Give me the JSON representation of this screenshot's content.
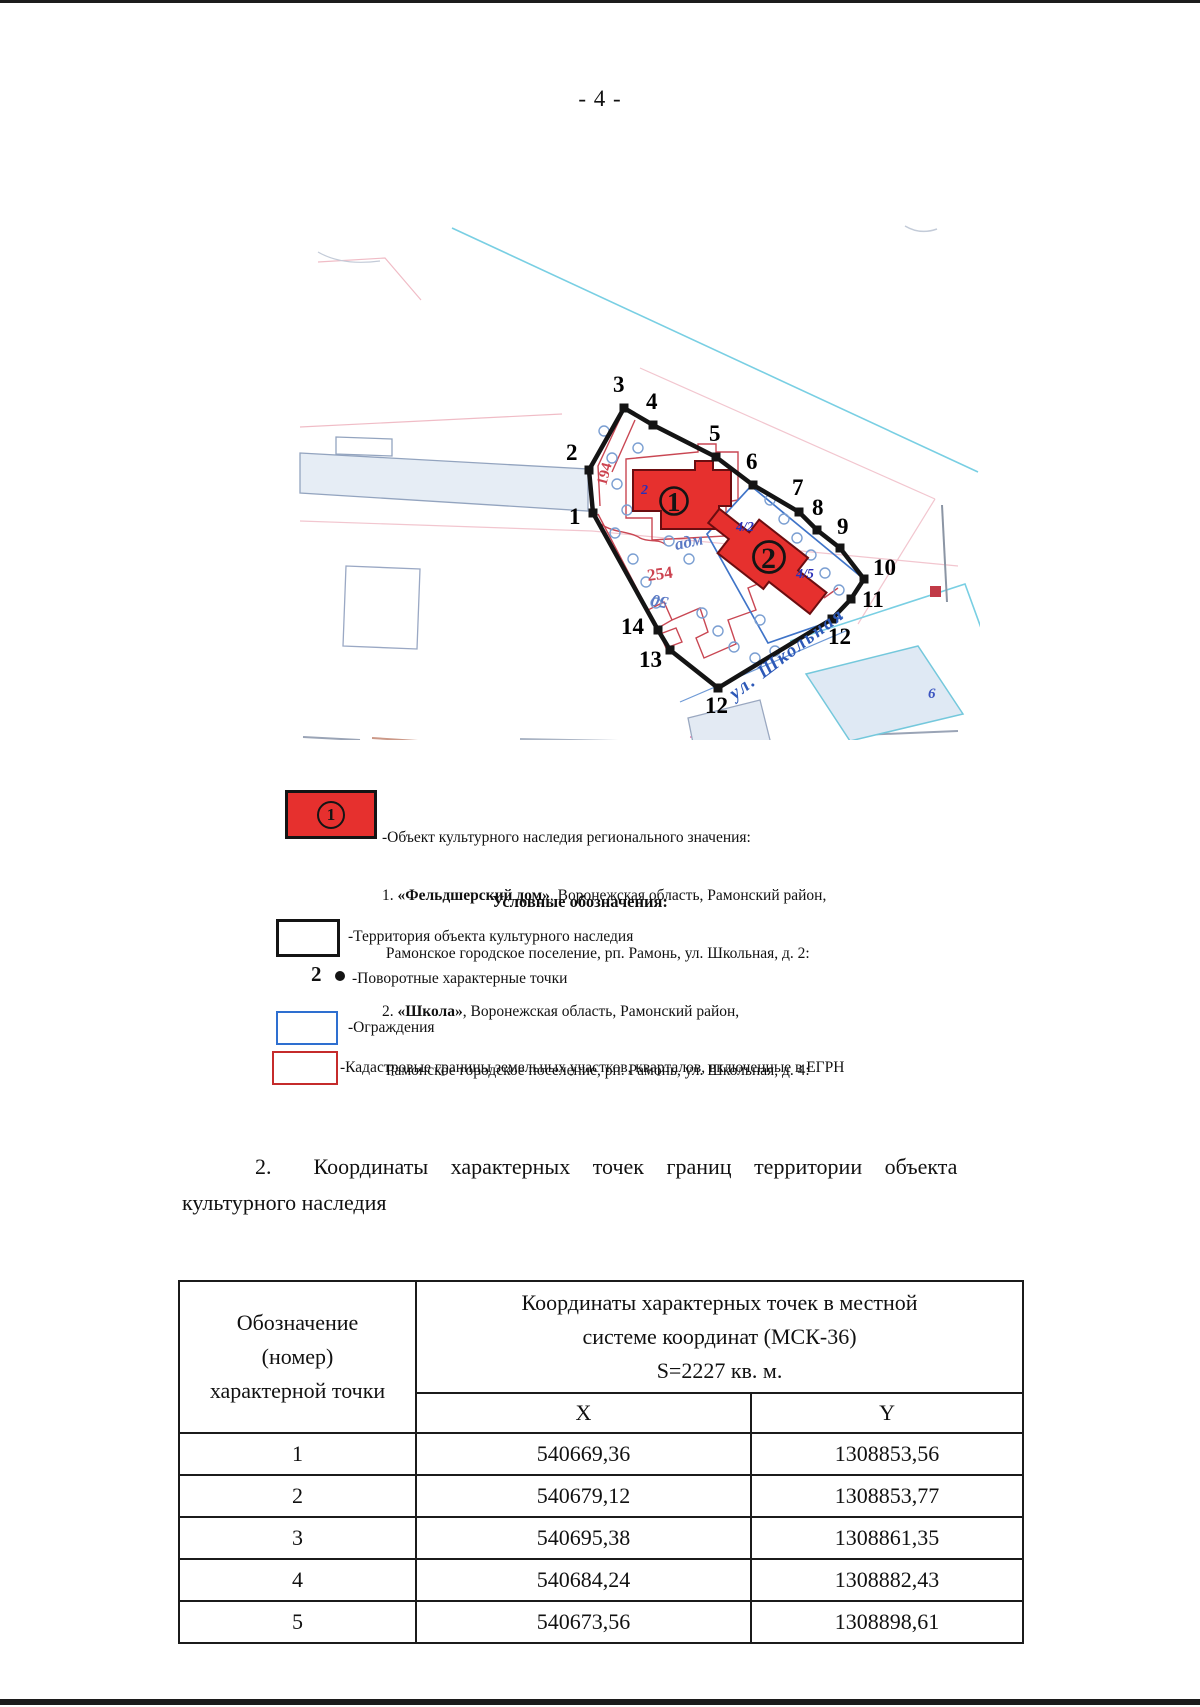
{
  "page": {
    "number": "- 4 -"
  },
  "map": {
    "boundary_points": [
      {
        "label": "1",
        "x": 593,
        "y": 513,
        "lx": 569,
        "ly": 524
      },
      {
        "label": "2",
        "x": 589,
        "y": 470,
        "lx": 566,
        "ly": 460
      },
      {
        "label": "3",
        "x": 624,
        "y": 408,
        "lx": 613,
        "ly": 392
      },
      {
        "label": "4",
        "x": 653,
        "y": 425,
        "lx": 646,
        "ly": 409
      },
      {
        "label": "5",
        "x": 716,
        "y": 457,
        "lx": 709,
        "ly": 441
      },
      {
        "label": "6",
        "x": 753,
        "y": 485,
        "lx": 746,
        "ly": 469
      },
      {
        "label": "7",
        "x": 799,
        "y": 512,
        "lx": 792,
        "ly": 495
      },
      {
        "label": "8",
        "x": 817,
        "y": 530,
        "lx": 812,
        "ly": 515
      },
      {
        "label": "9",
        "x": 840,
        "y": 548,
        "lx": 837,
        "ly": 534
      },
      {
        "label": "10",
        "x": 864,
        "y": 579,
        "lx": 873,
        "ly": 575
      },
      {
        "label": "11",
        "x": 851,
        "y": 599,
        "lx": 862,
        "ly": 607
      },
      {
        "label": "12",
        "x": 832,
        "y": 619,
        "lx": 828,
        "ly": 644
      },
      {
        "label": "12",
        "x": 718,
        "y": 688,
        "lx": 705,
        "ly": 713
      },
      {
        "label": "13",
        "x": 670,
        "y": 650,
        "lx": 639,
        "ly": 667
      },
      {
        "label": "14",
        "x": 658,
        "y": 630,
        "lx": 621,
        "ly": 634
      }
    ],
    "buildings": [
      {
        "circle_label": "1",
        "house_label": "2"
      },
      {
        "circle_label": "2",
        "house_labels": [
          "4/2",
          "4/5"
        ]
      }
    ],
    "street_label": "ул. Школьная",
    "parcel_labels": [
      {
        "text": "194"
      },
      {
        "text": "254"
      },
      {
        "text": "адм"
      },
      {
        "text": "50"
      },
      {
        "text": "6"
      }
    ]
  },
  "legend": {
    "object_symbol": "1",
    "object_lines": [
      {
        "pre": "-Объект культурного наследия регионального значения:",
        "bold": "",
        "post": ""
      },
      {
        "pre": "1. ",
        "bold": "«Фельдшерский дом»",
        "post": ", Воронежская область, Рамонский район,"
      },
      {
        "pre": " Рамонское городское поселение, рп. Рамонь, ул. Школьная, д. 2:",
        "bold": "",
        "post": ""
      },
      {
        "pre": "2. ",
        "bold": "«Школа»",
        "post": ", Воронежская область, Рамонский район,"
      },
      {
        "pre": " Рамонское городское поселение, рп. Рамонь, ул. Школьная, д. 4:",
        "bold": "",
        "post": ""
      }
    ],
    "symbols_title": "Условные обозначения:",
    "items": [
      {
        "label": "-Территория объекта культурного наследия"
      },
      {
        "point_number": "2",
        "label": "-Поворотные характерные точки"
      },
      {
        "label": "-Ограждения"
      },
      {
        "label": "-Кадастровые границы земельных участков, кварталов, включенные в ЕГРН"
      }
    ]
  },
  "section": {
    "number": "2.",
    "title_line1": "Координаты характерных точек границ территории объекта",
    "title_line2": "культурного наследия"
  },
  "coords_table": {
    "col1_header_lines": [
      "Обозначение",
      "(номер)",
      "характерной точки"
    ],
    "col2_header_lines": [
      "Координаты характерных точек в местной",
      "системе координат (МСК-36)",
      "S=2227 кв. м."
    ],
    "sub_headers": [
      "X",
      "Y"
    ],
    "rows": [
      [
        "1",
        "540669,36",
        "1308853,56"
      ],
      [
        "2",
        "540679,12",
        "1308853,77"
      ],
      [
        "3",
        "540695,38",
        "1308861,35"
      ],
      [
        "4",
        "540684,24",
        "1308882,43"
      ],
      [
        "5",
        "540673,56",
        "1308898,61"
      ]
    ]
  }
}
